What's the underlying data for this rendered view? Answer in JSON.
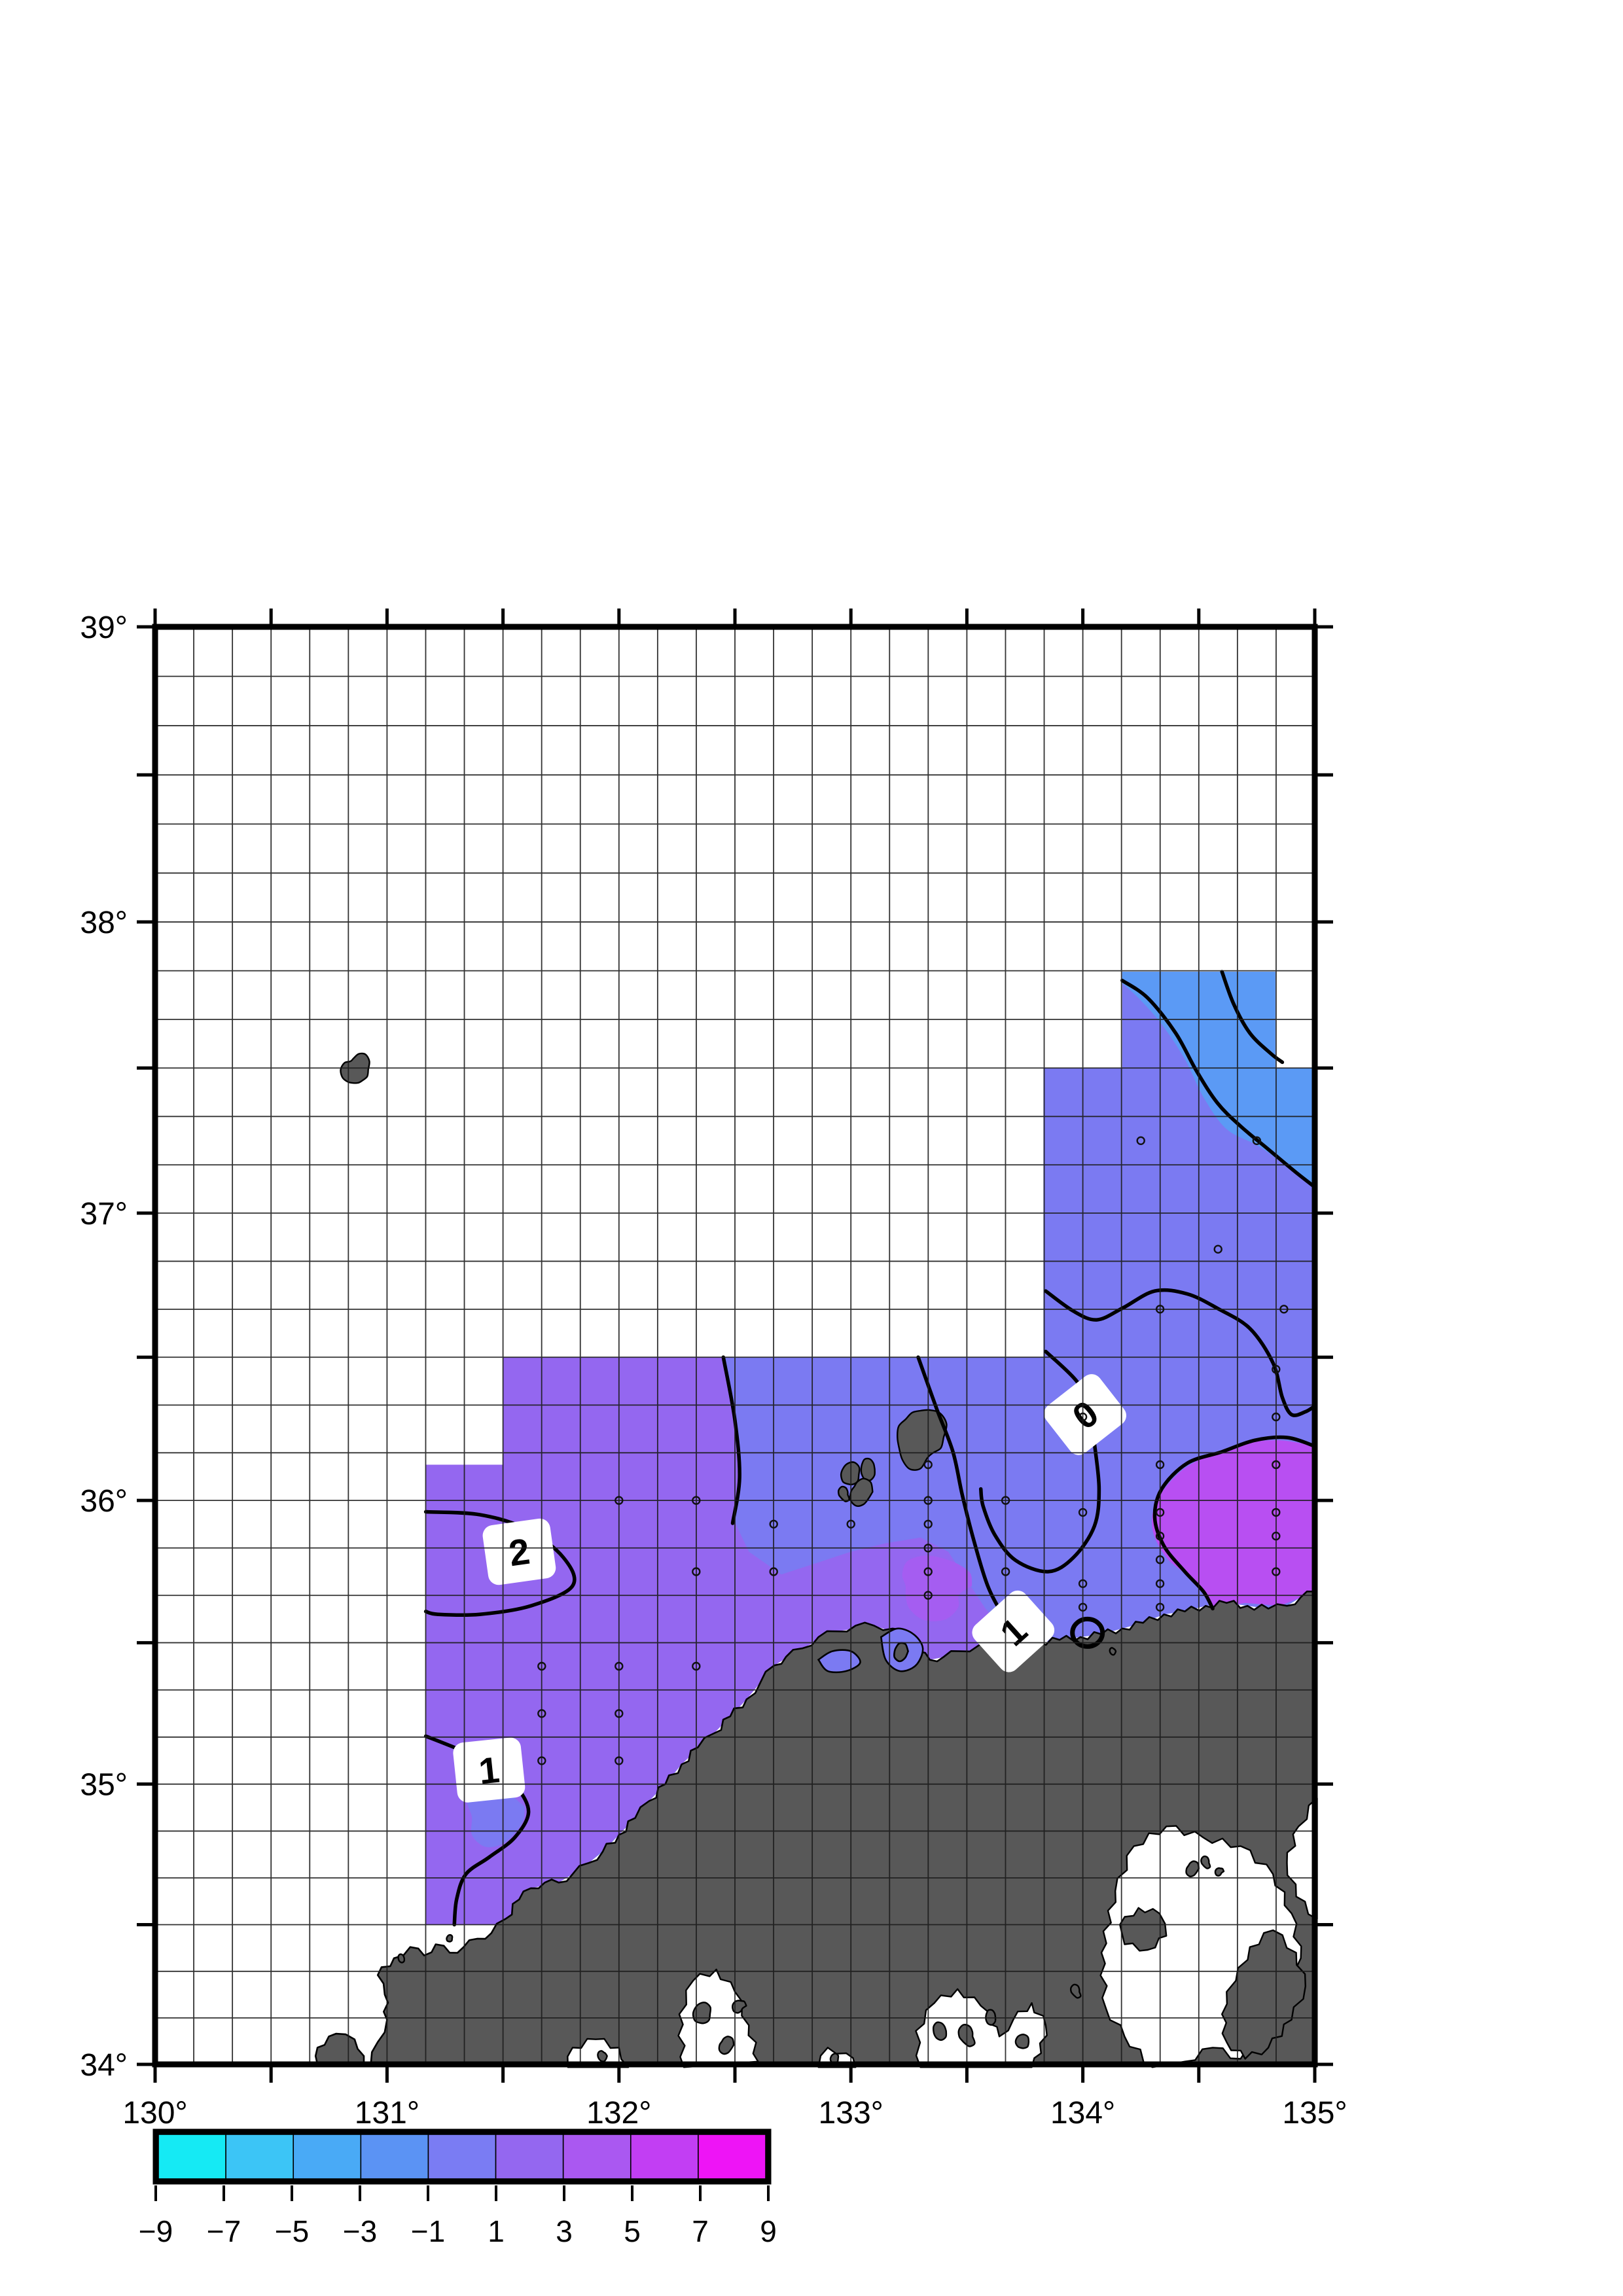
{
  "page": {
    "background": "#ffffff"
  },
  "map_frame": {
    "lon_min": 130,
    "lon_max": 135,
    "lat_min": 34,
    "lat_max": 39,
    "projection": "mercator",
    "grid_step_deg": 0.1666667,
    "tick_step_deg": 0.5,
    "frame_color": "#000000",
    "grid_color": "#1c1c1c",
    "land_color": "#585858",
    "coast_outline_color": "#000000",
    "water_color": "#ffffff",
    "x_axis_labels": [
      {
        "value": 130,
        "label": "130°"
      },
      {
        "value": 131,
        "label": "131°"
      },
      {
        "value": 132,
        "label": "132°"
      },
      {
        "value": 133,
        "label": "133°"
      },
      {
        "value": 134,
        "label": "134°"
      },
      {
        "value": 135,
        "label": "135°"
      }
    ],
    "y_axis_labels": [
      {
        "value": 34,
        "label": "34°"
      },
      {
        "value": 35,
        "label": "35°"
      },
      {
        "value": 36,
        "label": "36°"
      },
      {
        "value": 37,
        "label": "37°"
      },
      {
        "value": 38,
        "label": "38°"
      },
      {
        "value": 39,
        "label": "39°"
      }
    ]
  },
  "chart_data": {
    "type": "heatmap",
    "title": "",
    "x": {
      "label": "",
      "range": [
        130,
        135
      ],
      "tick_labels": [
        "130°",
        "131°",
        "132°",
        "133°",
        "134°",
        "135°"
      ]
    },
    "y": {
      "label": "",
      "range": [
        34,
        39
      ],
      "tick_labels": [
        "34°",
        "35°",
        "36°",
        "37°",
        "38°",
        "39°"
      ]
    },
    "grid_on": true,
    "legend_position": "bottom-left",
    "contour_levels_labeled": [
      0,
      1,
      2
    ],
    "contour_labels": [
      {
        "text": "2",
        "lon": 131.57,
        "lat": 35.82,
        "rotation": -8
      },
      {
        "text": "1",
        "lon": 131.44,
        "lat": 35.05,
        "rotation": -6
      },
      {
        "text": "0",
        "lon": 134.01,
        "lat": 36.3,
        "rotation": -38
      },
      {
        "text": "1",
        "lon": 133.7,
        "lat": 35.54,
        "rotation": -42
      }
    ],
    "field_regions": [
      {
        "value_range": [
          -3,
          -1
        ],
        "color": "#5b9af5",
        "where": "northeast arm"
      },
      {
        "value_range": [
          -1,
          1
        ],
        "color": "#7b7af2",
        "where": "central and eastern offshore"
      },
      {
        "value_range": [
          1,
          3
        ],
        "color": "#9467f0",
        "where": "western block and coastal tongue"
      },
      {
        "value_range": [
          3,
          5
        ],
        "color": "#b84ff2",
        "where": "southeast patch near 134.6E 36N"
      },
      {
        "value_range": [
          3,
          5
        ],
        "color": "#a55df1",
        "where": "small patch south of Oki Islands"
      }
    ],
    "data_extent_bands": [
      {
        "lat_range": [
          34.5,
          36.125
        ],
        "lon_range": [
          131.167,
          135
        ]
      },
      {
        "lat_range": [
          36.125,
          36.5
        ],
        "lon_range": [
          131.5,
          135
        ]
      },
      {
        "lat_range": [
          36.5,
          37.5
        ],
        "lon_range": [
          133.83,
          135
        ]
      },
      {
        "lat_range": [
          37.5,
          37.83
        ],
        "lon_range": [
          134.17,
          134.83
        ]
      }
    ],
    "data_points_lonlat": [
      [
        131.667,
        35.417
      ],
      [
        131.667,
        35.25
      ],
      [
        131.667,
        35.083
      ],
      [
        132.0,
        36.0
      ],
      [
        132.0,
        35.417
      ],
      [
        132.0,
        35.25
      ],
      [
        132.0,
        35.083
      ],
      [
        132.333,
        36.0
      ],
      [
        132.333,
        35.75
      ],
      [
        132.333,
        35.417
      ],
      [
        132.667,
        35.917
      ],
      [
        132.667,
        35.75
      ],
      [
        133.0,
        35.917
      ],
      [
        133.333,
        36.125
      ],
      [
        133.333,
        36.0
      ],
      [
        133.333,
        35.917
      ],
      [
        133.333,
        35.833
      ],
      [
        133.333,
        35.75
      ],
      [
        133.333,
        35.667
      ],
      [
        133.667,
        36.0
      ],
      [
        133.667,
        35.75
      ],
      [
        134.0,
        36.292
      ],
      [
        134.0,
        35.958
      ],
      [
        134.0,
        35.708
      ],
      [
        134.0,
        35.625
      ],
      [
        134.333,
        36.125
      ],
      [
        134.333,
        35.958
      ],
      [
        134.333,
        35.875
      ],
      [
        134.333,
        35.792
      ],
      [
        134.333,
        35.708
      ],
      [
        134.333,
        35.625
      ],
      [
        134.833,
        36.458
      ],
      [
        134.833,
        36.292
      ],
      [
        134.833,
        36.125
      ],
      [
        134.833,
        35.958
      ],
      [
        134.833,
        35.875
      ],
      [
        134.833,
        35.75
      ],
      [
        134.333,
        36.667
      ],
      [
        134.867,
        36.667
      ],
      [
        134.25,
        37.25
      ],
      [
        134.75,
        37.25
      ],
      [
        134.583,
        36.875
      ]
    ],
    "colorbar": {
      "range": [
        -9,
        9
      ],
      "cell_edges": [
        -9,
        -7,
        -5,
        -3,
        -1,
        1,
        3,
        5,
        7,
        9
      ],
      "tick_labels": [
        "−9",
        "−7",
        "−5",
        "−3",
        "−1",
        "1",
        "3",
        "5",
        "7",
        "9"
      ],
      "cell_colors": [
        "#15eaf4",
        "#3cc5f6",
        "#49aaf6",
        "#5b93f4",
        "#7a7cf3",
        "#9467f0",
        "#aa58f1",
        "#c23ef3",
        "#ee14f6"
      ]
    }
  }
}
